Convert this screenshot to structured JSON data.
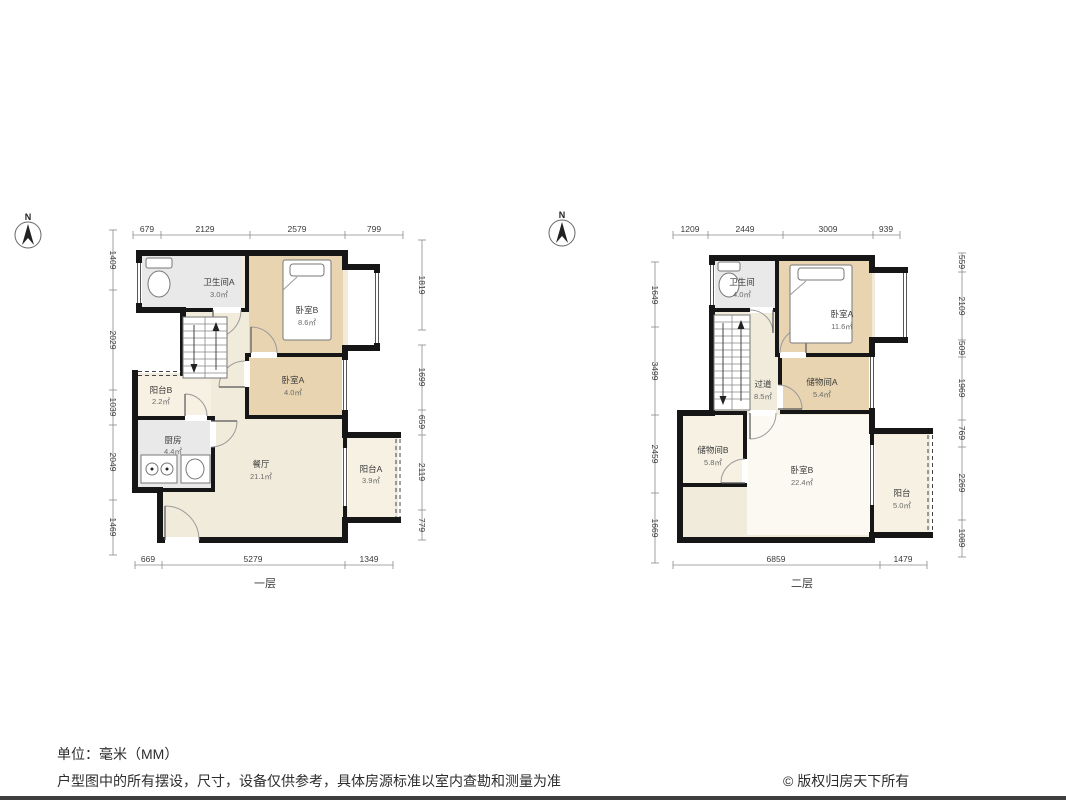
{
  "colors": {
    "wall": "#161616",
    "bedroom": "#e8d4b0",
    "service": "#e9e9e9",
    "cream": "#f1ebdb",
    "balcony": "#f6f1e2",
    "roomlight": "#fbf9f1"
  },
  "compass": {
    "label": "N"
  },
  "floor1": {
    "label": "一层",
    "dims_top": [
      "679",
      "2129",
      "2579",
      "799"
    ],
    "dims_left": [
      "1409",
      "2029",
      "1039",
      "2049",
      "1469"
    ],
    "dims_right": [
      "1819",
      "1699",
      "659",
      "2119",
      "779"
    ],
    "dims_bottom": [
      "669",
      "5279",
      "1349"
    ],
    "rooms": {
      "bathroom": {
        "name": "卫生间A",
        "area": "3.0㎡"
      },
      "bedroom_b": {
        "name": "卧室B",
        "area": "8.6㎡"
      },
      "bedroom_a": {
        "name": "卧室A",
        "area": "4.0㎡"
      },
      "balcony_b": {
        "name": "阳台B",
        "area": "2.2㎡"
      },
      "kitchen": {
        "name": "厨房",
        "area": "4.4㎡"
      },
      "dining": {
        "name": "餐厅",
        "area": "21.1㎡"
      },
      "balcony_a": {
        "name": "阳台A",
        "area": "3.9㎡"
      }
    }
  },
  "floor2": {
    "label": "二层",
    "dims_top": [
      "1209",
      "2449",
      "3009",
      "939"
    ],
    "dims_left": [
      "1649",
      "3499",
      "2459",
      "1669"
    ],
    "dims_right": [
      "559",
      "2109",
      "509",
      "1969",
      "769",
      "2269",
      "1089"
    ],
    "dims_bottom": [
      "6859",
      "1479"
    ],
    "rooms": {
      "bathroom": {
        "name": "卫生间",
        "area": "4.0㎡"
      },
      "bedroom_a": {
        "name": "卧室A",
        "area": "11.6㎡"
      },
      "hallway": {
        "name": "过道",
        "area": "8.5㎡"
      },
      "storage_a": {
        "name": "储物间A",
        "area": "5.4㎡"
      },
      "storage_b": {
        "name": "储物间B",
        "area": "5.8㎡"
      },
      "bedroom_b": {
        "name": "卧室B",
        "area": "22.4㎡"
      },
      "balcony": {
        "name": "阳台",
        "area": "5.0㎡"
      }
    }
  },
  "footer": {
    "unit": "单位：毫米（MM）",
    "disclaimer": "户型图中的所有摆设，尺寸，设备仅供参考，具体房源标准以室内查勘和测量为准",
    "copyright": "© 版权归房天下所有"
  }
}
